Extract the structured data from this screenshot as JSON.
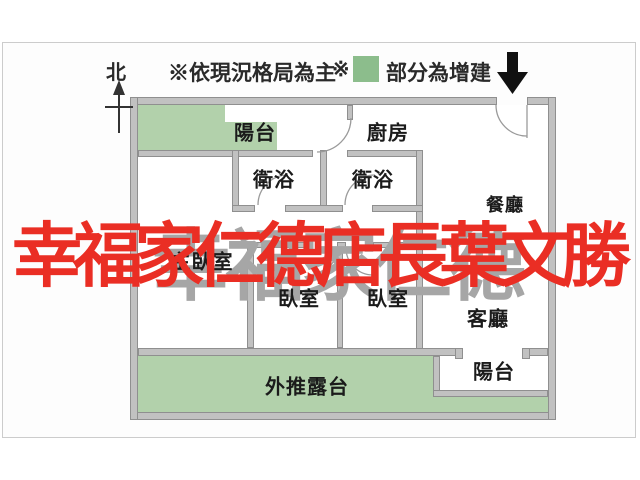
{
  "compass": {
    "label": "北"
  },
  "legend": {
    "note_main": "※依現況格局為主",
    "note_prefix": "※",
    "note_addition": "部分為增建",
    "addition_color": "#8cbd8c"
  },
  "entry": {
    "arrow_icon": "entry-down-arrow",
    "arrow_color": "#111111"
  },
  "rooms": {
    "balcony_top": "陽台",
    "kitchen": "廚房",
    "bath_1": "衛浴",
    "bath_2": "衛浴",
    "dining": "餐廳",
    "master_bedroom": "主臥室",
    "bedroom_1": "臥室",
    "bedroom_2": "臥室",
    "living": "客廳",
    "balcony_bottom": "陽台",
    "terrace": "外推露台"
  },
  "watermark": {
    "red_text": "幸福家仁德店長葉文勝",
    "red_color": "#ea2e24",
    "gray_text": "幸福家仁德",
    "gray_color": "#a6a6a6"
  },
  "colors": {
    "wall_fill": "#c1c1c1",
    "wall_outline": "#8f8f8f",
    "addition_fill": "#b2d1ab",
    "frame_border": "#cccccc"
  }
}
